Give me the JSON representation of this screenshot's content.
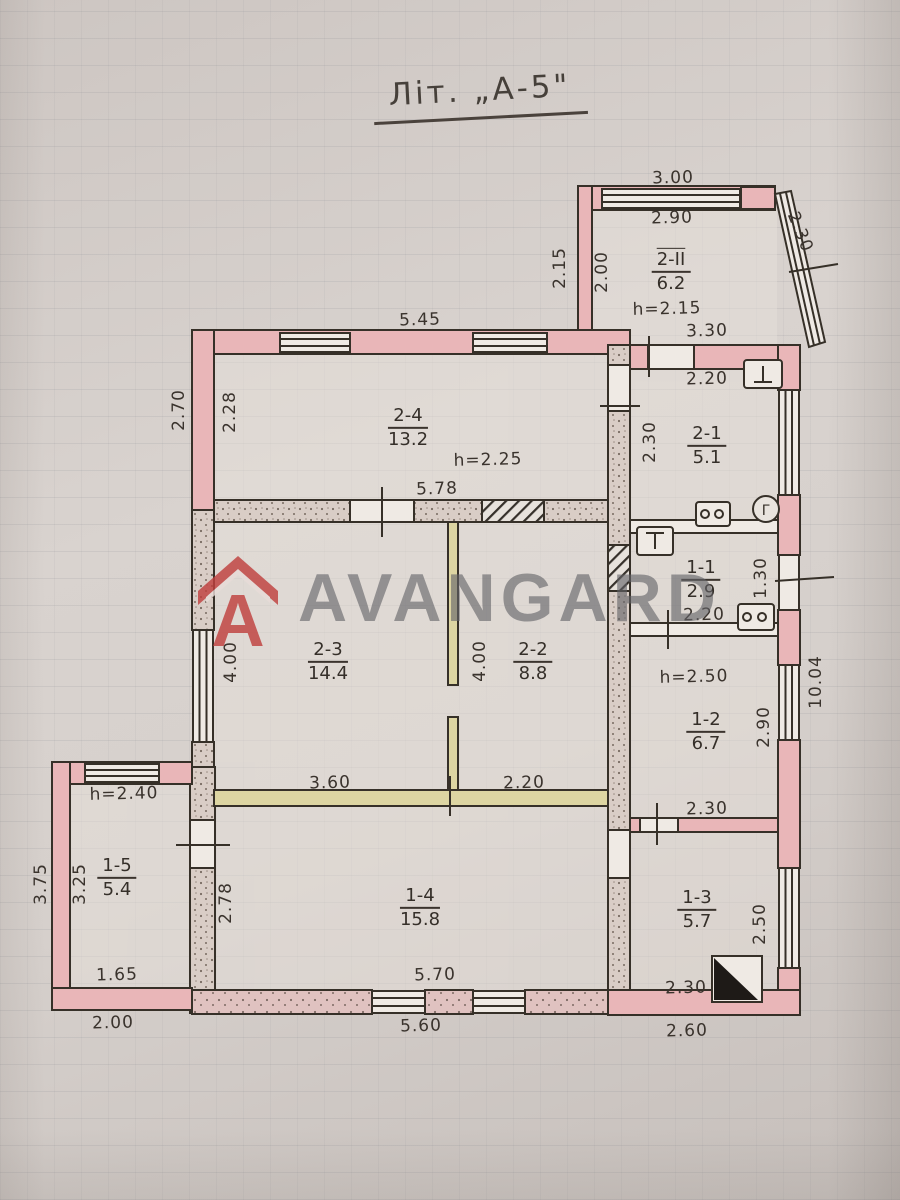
{
  "title": "Літ. „А-5\"",
  "watermark": {
    "brand": "AVANGARD"
  },
  "rooms": {
    "r2II": {
      "id": "2-II",
      "area": "6.2",
      "h": "h=2.15"
    },
    "r24": {
      "id": "2-4",
      "area": "13.2",
      "h": "h=2.25"
    },
    "r21": {
      "id": "2-1",
      "area": "5.1"
    },
    "r23": {
      "id": "2-3",
      "area": "14.4"
    },
    "r22": {
      "id": "2-2",
      "area": "8.8"
    },
    "r11": {
      "id": "1-1",
      "area": "2.9"
    },
    "r12": {
      "id": "1-2",
      "area": "6.7",
      "h": "h=2.50"
    },
    "r15": {
      "id": "1-5",
      "area": "5.4",
      "h": "h=2.40"
    },
    "r14": {
      "id": "1-4",
      "area": "15.8"
    },
    "r13": {
      "id": "1-3",
      "area": "5.7"
    }
  },
  "dims": {
    "annex_top": "3.00",
    "annex_top_in": "2.90",
    "annex_right": "2.30",
    "annex_left_out": "2.15",
    "annex_left_in": "2.00",
    "annex_bottom": "3.30",
    "r24_top": "5.45",
    "r21_top": "2.20",
    "main_left": "2.70",
    "r24_left": "2.28",
    "r21_left": "2.30",
    "r24_bottom": "5.78",
    "r11_right": "1.30",
    "r11_bottom": "2.20",
    "r23_left": "4.00",
    "r22_left": "4.00",
    "r12_right": "2.90",
    "right_total": "10.04",
    "r23_bottom": "3.60",
    "r22_bottom": "2.20",
    "r12_bottom": "2.30",
    "r15_left_out": "3.75",
    "r15_left_in": "3.25",
    "r15_bottom_in": "1.65",
    "r15_bottom_out": "2.00",
    "r14_left": "2.78",
    "r14_bottom_in": "5.70",
    "r14_bottom_out": "5.60",
    "r13_right": "2.50",
    "r13_bottom_in": "2.30",
    "r13_bottom_out": "2.60"
  },
  "symbols": {
    "gas_meter": "Г"
  }
}
